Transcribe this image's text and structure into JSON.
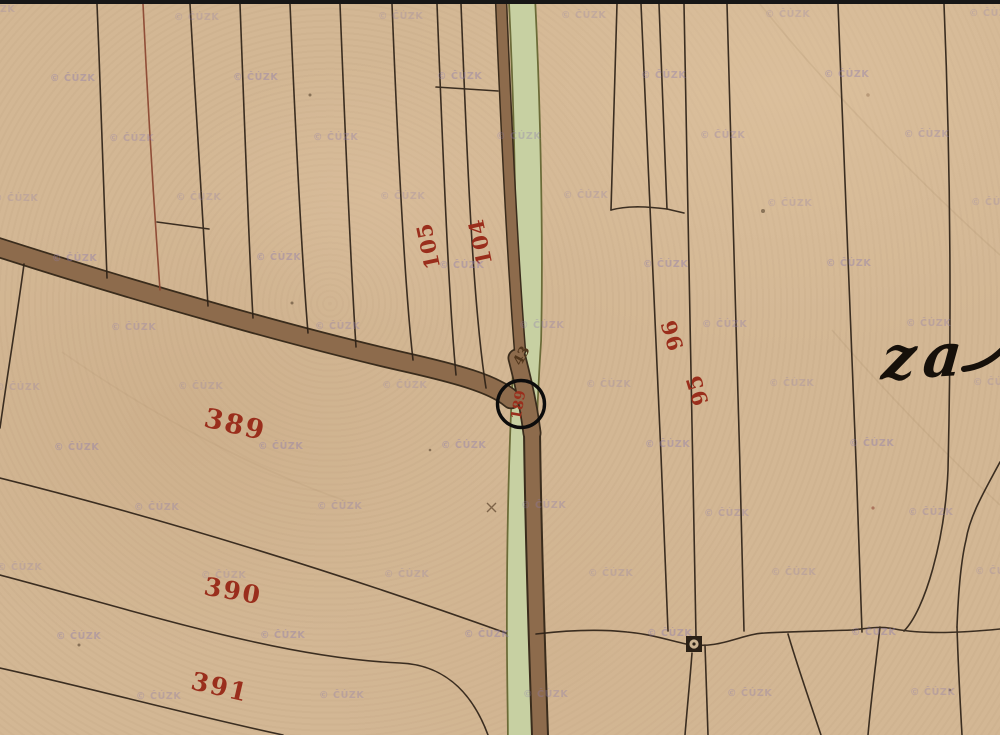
{
  "map": {
    "watermark": {
      "text": "© ČÚZK",
      "color": "#8d7cae"
    },
    "parcel_labels": {
      "p389": {
        "text": "389"
      },
      "p390": {
        "text": "390"
      },
      "p391": {
        "text": "391"
      },
      "p105": {
        "text": "105"
      },
      "p104": {
        "text": "104"
      },
      "p96": {
        "text": "96"
      },
      "p95": {
        "text": "95"
      },
      "p43": {
        "text": "43"
      },
      "p189": {
        "text": "189"
      }
    },
    "place_name": {
      "text": "za"
    },
    "symbols": {
      "marker": "square-circle-boundary-marker",
      "annotation": "highlight-circle"
    },
    "colors": {
      "red": "#9a2e1c",
      "darknum": "#51361c",
      "script": "#16100a",
      "ink": "#2e2217",
      "road": "#8d6b4c",
      "roadedge": "#3a2c1c",
      "green": "#c7d0a2",
      "greenedge": "#6b6b38",
      "wm": "#8d7cae"
    }
  }
}
